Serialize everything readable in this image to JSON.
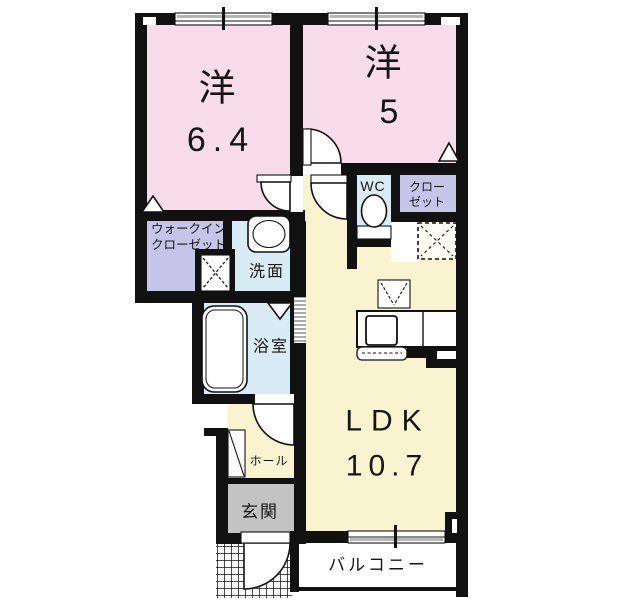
{
  "plan_title": "1LDK floor plan",
  "rooms": {
    "western1": {
      "label": "洋",
      "size": "6.4"
    },
    "western2": {
      "label": "洋",
      "size": "5"
    },
    "ldk": {
      "label": "LDK",
      "size": "10.7"
    },
    "wc": {
      "label": "WC"
    },
    "closet": {
      "line1": "クロー",
      "line2": "ゼット"
    },
    "walk_in_closet": {
      "line1": "ウォークイン",
      "line2": "クローゼット"
    },
    "washroom": {
      "label": "洗面"
    },
    "bathroom": {
      "label": "浴室"
    },
    "hall": {
      "label": "ホール"
    },
    "entrance": {
      "label": "玄関"
    },
    "balcony": {
      "label": "バルコニー"
    }
  },
  "colors": {
    "room_pink": "#f8dce9",
    "room_yellow": "#faf3d0",
    "room_blue": "#d9ecf6",
    "room_purple": "#c7c4e9",
    "entrance_gray": "#c3c3c3",
    "wall_black": "#111111"
  }
}
